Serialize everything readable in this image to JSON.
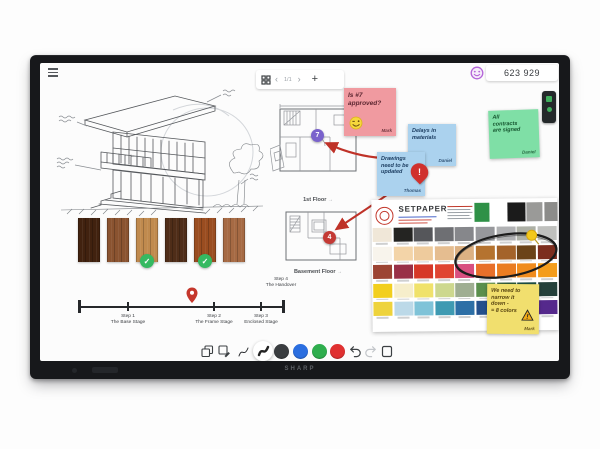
{
  "brand": "SHARP",
  "topbar": {
    "page_indicator": "1/1",
    "reaction_count": "623 929"
  },
  "icons": {
    "prev": "‹",
    "next": "›",
    "add": "+",
    "plan_link": "→",
    "check": "✓",
    "alert": "!"
  },
  "notes": {
    "pink": {
      "line1": "Is #7",
      "line2": "approved?",
      "author": "Mark"
    },
    "blue_delays": {
      "line1": "Delays in",
      "line2": "materials",
      "author": "Daniel"
    },
    "blue_drawings": {
      "line1": "Drawings",
      "line2": "need to be",
      "line3": "updated",
      "author": "Thomas"
    },
    "green": {
      "line1": "All",
      "line2": "contracts",
      "line3": "are signed",
      "author": "Daniel"
    },
    "yellow": {
      "line1": "We need to",
      "line2": "narrow it",
      "line3": "down -",
      "line4": "= 8 colors",
      "author": "Mark"
    }
  },
  "plans": {
    "first_floor": {
      "label": "1st Floor",
      "badge": "7"
    },
    "basement": {
      "label": "Basement Floor",
      "badge": "4"
    }
  },
  "timeline": {
    "steps": [
      {
        "title": "Step 1",
        "subtitle": "The Base Stage"
      },
      {
        "title": "Step 2",
        "subtitle": "The Frame Stage"
      },
      {
        "title": "Step 3",
        "subtitle": "Enclosed Stage"
      },
      {
        "title": "Step 4",
        "subtitle": "The Handover"
      }
    ]
  },
  "materials": {
    "wood_colors": [
      "#41220f",
      "#8a5330",
      "#c08a4e",
      "#4f2d18",
      "#9a4d20",
      "#a66a44"
    ],
    "approved_indexes": [
      2,
      4
    ]
  },
  "palette": {
    "title": "SETPAPER",
    "header_swatches": [
      "#2f9147",
      "#1b1b1b",
      "#9a9a98",
      "#8c8c8a"
    ],
    "rows": [
      [
        "#f0e7d8",
        "#242422",
        "#55565a",
        "#6e6f73",
        "#86878b",
        "#97989c",
        "#b0b1b3",
        "#adb0a6",
        "#bfc0bd"
      ],
      [
        "#f8f4ec",
        "#f3d4a8",
        "#eecb9d",
        "#e5bd90",
        "#dcb183",
        "#b5732f",
        "#a4632a",
        "#6b4318",
        "#7c2d1e"
      ],
      [
        "#9c4434",
        "#993047",
        "#d63828",
        "#e04532",
        "#d84f80",
        "#e8702a",
        "#ea7d22",
        "#f08c1e",
        "#f49d1c"
      ],
      [
        "#f2cf1e",
        "#f6eecb",
        "#f0e26b",
        "#cdd88e",
        "#9fae92",
        "#5a8f4c",
        "#2e5a3a",
        "#1e4f44",
        "#24403a"
      ],
      [
        "#eed33c",
        "#bcd9e8",
        "#7fc3d8",
        "#3e9ab2",
        "#2d6fa6",
        "#24508c",
        "#223a6a",
        "#38296b",
        "#55298c"
      ]
    ]
  },
  "draw_toolbar": {
    "pen_colors": [
      "#3a3d40",
      "#2b6ee0",
      "#2fae4e",
      "#e03131"
    ],
    "pen_color_names": [
      "dark",
      "blue",
      "green",
      "red"
    ]
  }
}
